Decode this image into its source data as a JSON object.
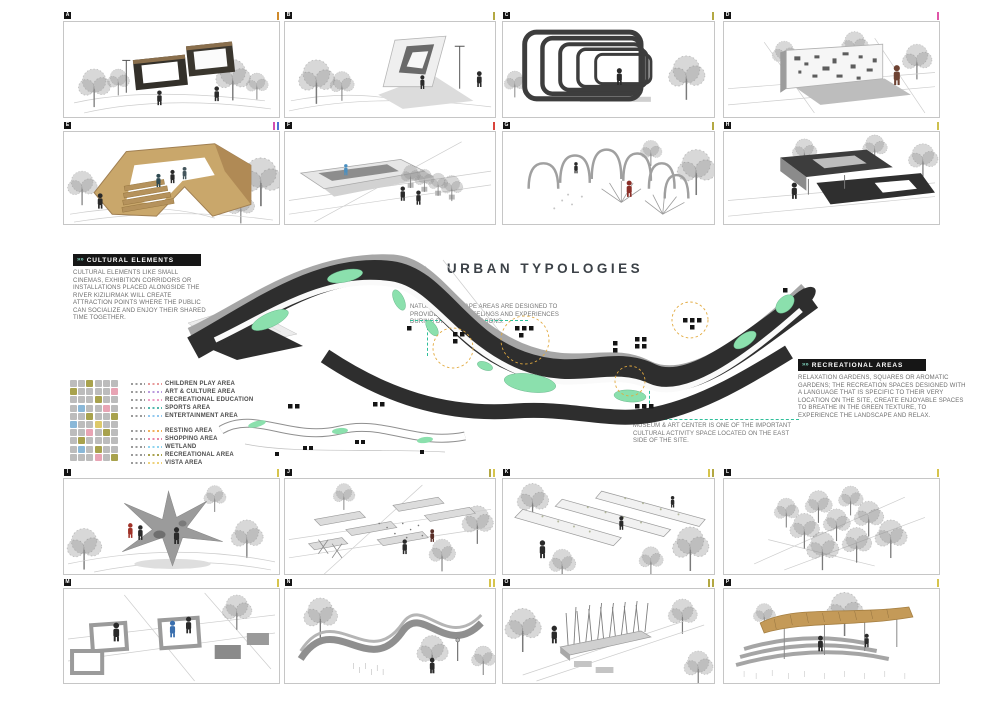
{
  "title": "URBAN TYPOLOGIES",
  "icons": {
    "header_chevrons": "»»"
  },
  "sections": {
    "cultural": {
      "header": "CULTURAL ELEMENTS",
      "body": "CULTURAL ELEMENTS LIKE SMALL CINEMAS, EXHIBITION CORRIDORS OR INSTALLATIONS PLACED ALONGSIDE THE RIVER KIZILIRMAK WILL CREATE ATTRACTION POINTS WHERE THE PUBLIC CAN SOCIALIZE AND ENJOY THEIR SHARED TIME TOGETHER."
    },
    "recreational": {
      "header": "RECREATIONAL AREAS",
      "body": "RELAXATION GARDENS, SQUARES OR AROMATIC GARDENS; THE RECREATION SPACES DESIGNED WITH A LANGUAGE THAT IS SPECIFIC TO THEIR VERY LOCATION ON THE SITE, CREATE ENJOYABLE SPACES TO BREATHE IN THE GREEN TEXTURE, TO EXPERIENCE THE LANDSCAPE AND RELAX."
    }
  },
  "annotations": {
    "natural": "NATURAL LANDSCAPE AREAS ARE DESIGNED TO PROVIDE VARIOUS FEELINGS AND EXPERIENCES DURING DIFFERENT SEASONS.",
    "museum": "MUSEUM & ART CENTER IS ONE OF THE IMPORTANT CULTURAL ACTIVITY SPACE LOCATED ON THE EAST SIDE OF THE SITE."
  },
  "legend": {
    "groups": [
      [
        {
          "label": "CHILDREN PLAY AREA",
          "color": "#e89a9a"
        },
        {
          "label": "ART & CULTURE AREA",
          "color": "#b99add"
        },
        {
          "label": "RECREATIONAL EDUCATION",
          "color": "#ef9ec4"
        },
        {
          "label": "SPORTS AREA",
          "color": "#52b8ac"
        },
        {
          "label": "ENTERTAINMENT AREA",
          "color": "#92c8ef"
        }
      ],
      [
        {
          "label": "RESTING AREA",
          "color": "#f0b05a"
        },
        {
          "label": "SHOPPING AREA",
          "color": "#e884a8"
        },
        {
          "label": "WETLAND",
          "color": "#8fd4ef"
        },
        {
          "label": "RECREATIONAL AREA",
          "color": "#a8a24d"
        },
        {
          "label": "VISTA AREA",
          "color": "#eed27a"
        }
      ]
    ],
    "grid": [
      "ggoggg",
      "oggggp",
      "gggogg",
      "gbggpg",
      "ggoggo",
      "bggygg",
      "ggpgog",
      "gogggg",
      "gbgogg",
      "gggpgo"
    ],
    "grid_colors": {
      "g": "#bcbcbc",
      "o": "#a8a24d",
      "p": "#e8a4b4",
      "b": "#8ab8d8",
      "y": "#ddc96a"
    }
  },
  "panels": [
    {
      "id": "A",
      "ticks": [
        "#cf8a2b"
      ]
    },
    {
      "id": "B",
      "ticks": [
        "#b3a843"
      ]
    },
    {
      "id": "C",
      "ticks": [
        "#b3a843"
      ]
    },
    {
      "id": "D",
      "ticks": [
        "#e055a8"
      ]
    },
    {
      "id": "E",
      "ticks": [
        "#d44fb1",
        "#4f6fd4"
      ]
    },
    {
      "id": "F",
      "ticks": [
        "#d9443c"
      ]
    },
    {
      "id": "G",
      "ticks": [
        "#b3a843"
      ]
    },
    {
      "id": "H",
      "ticks": [
        "#cdc04e"
      ]
    },
    {
      "id": "I",
      "ticks": [
        "#d6c44c"
      ]
    },
    {
      "id": "J",
      "ticks": [
        "#b3a843",
        "#d6c44c"
      ]
    },
    {
      "id": "K",
      "ticks": [
        "#d6c44c",
        "#b3a843"
      ]
    },
    {
      "id": "L",
      "ticks": [
        "#d6c44c"
      ]
    },
    {
      "id": "M",
      "ticks": [
        "#d6c44c"
      ]
    },
    {
      "id": "N",
      "ticks": [
        "#d6c44c",
        "#d6c44c"
      ]
    },
    {
      "id": "O",
      "ticks": [
        "#b3a843",
        "#b3a843"
      ]
    },
    {
      "id": "P",
      "ticks": [
        "#d6c44c"
      ]
    }
  ],
  "colors": {
    "map_dark": "#2e2e2e",
    "map_green": "#8be0ad",
    "map_road": "#a6a6a6",
    "annotation_teal": "#2fbf9a",
    "highlight_amber": "#e2aa3f"
  }
}
